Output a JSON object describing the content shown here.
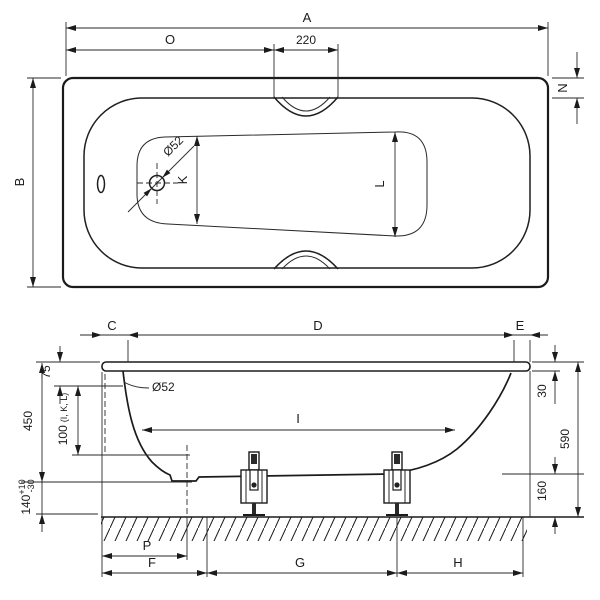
{
  "top_view": {
    "overall_length_label": "A",
    "drain_offset_label": "O",
    "grip_recess_width": "220",
    "rim_width_label": "N",
    "overall_width_label": "B",
    "floor_width_drain_end_label": "K",
    "floor_width_foot_end_label": "L",
    "drain_diameter": "Ø52"
  },
  "side_view": {
    "rim_left_label": "C",
    "top_length_label": "D",
    "rim_right_label": "E",
    "overflow_diameter": "Ø52",
    "rim_to_overflow": "75",
    "measure_height": "100",
    "measure_height_note": "(I, K, L)",
    "interior_depth": "450",
    "foot_height": "140",
    "foot_height_tol_plus": "+10",
    "foot_height_tol_minus": "-30",
    "interior_length_label": "I",
    "rim_section_height": "30",
    "total_height": "590",
    "under_clearance": "160",
    "drain_position_label": "P",
    "foot_left_label": "F",
    "foot_spacing_label": "G",
    "foot_right_label": "H"
  }
}
